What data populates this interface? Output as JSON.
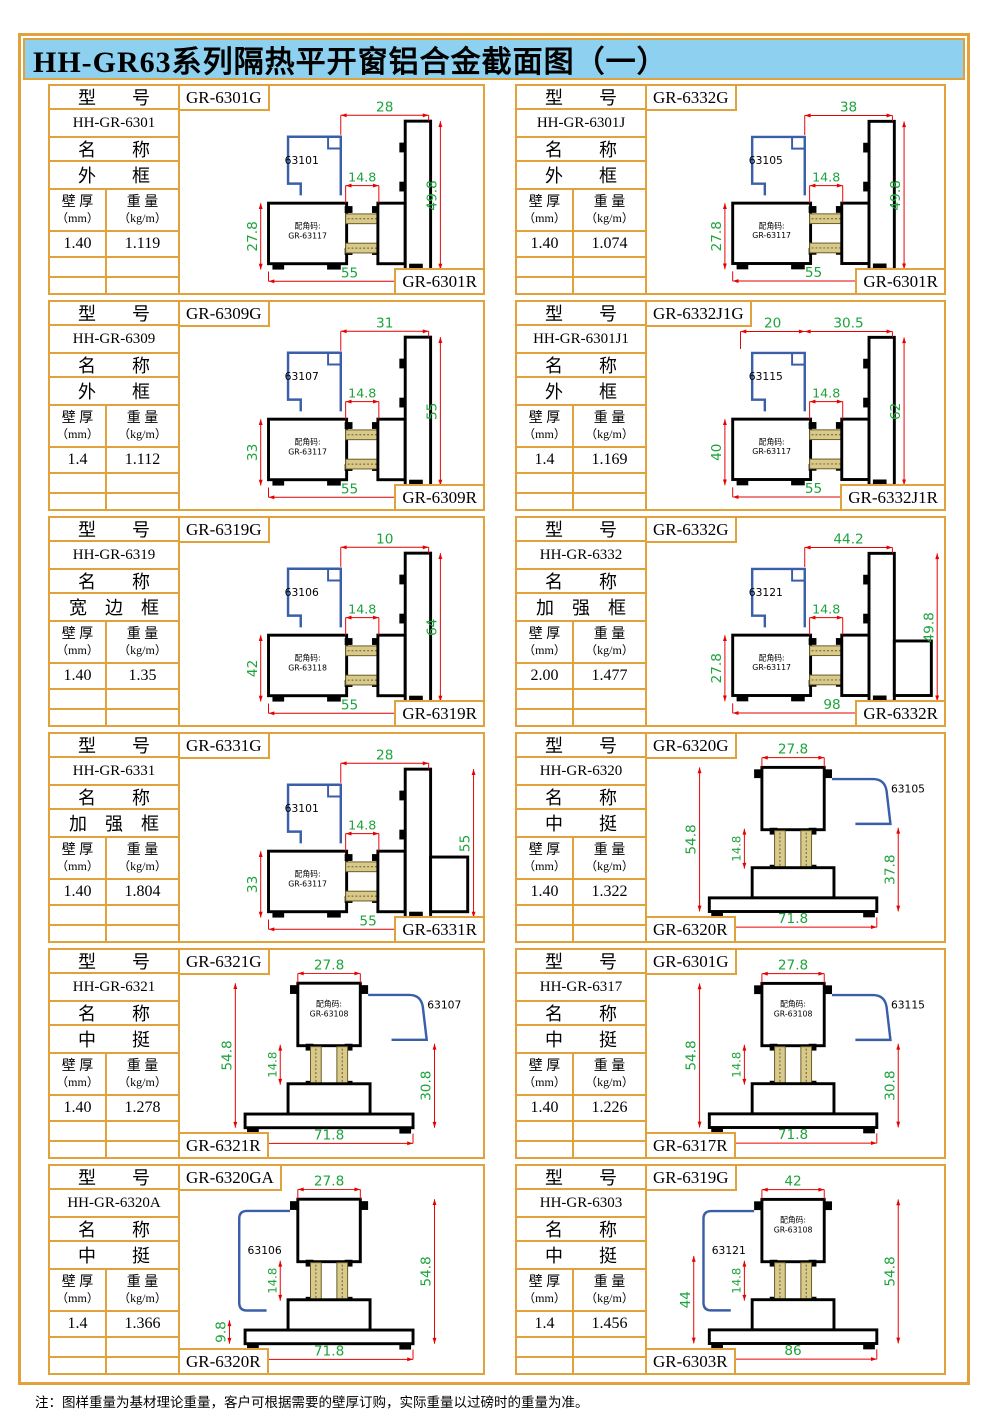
{
  "title": "HH-GR63系列隔热平开窗铝合金截面图（一）",
  "note": "注：图样重量为基材理论重量，客户可根据需要的壁厚订购，实际重量以过磅时的重量为准。",
  "labels": {
    "model": "型　　号",
    "name": "名　　称",
    "thickness": "壁 厚",
    "thickness_unit": "（mm）",
    "weight": "重 量",
    "weight_unit": "（kg/m）",
    "corner_prefix": "配角码:"
  },
  "colors": {
    "border": "#e2a23b",
    "title_bg": "#8dd0f0",
    "dim_line": "#e60000",
    "dim_text": "#1ea43c",
    "profile": "#000000",
    "sash_blue": "#3b5ea8",
    "thermal_tan": "#d8c98c"
  },
  "cells": [
    {
      "model": "HH-GR-6301",
      "type_name": "外　　框",
      "thickness": "1.40",
      "weight": "1.119",
      "glabel": "GR-6301G",
      "rlabel": "GR-6301R",
      "rside": "right",
      "part": "63101",
      "corner": "GR-63117",
      "draw": {
        "type": "A",
        "top": "28",
        "inner": "14.8",
        "left": "27.8",
        "right": "49.8",
        "bottom": "55"
      }
    },
    {
      "model": "HH-GR-6301J",
      "type_name": "外　　框",
      "thickness": "1.40",
      "weight": "1.074",
      "glabel": "GR-6332G",
      "rlabel": "GR-6301R",
      "rside": "right",
      "part": "63105",
      "corner": "GR-63117",
      "draw": {
        "type": "A",
        "top": "38",
        "inner": "14.8",
        "left": "27.8",
        "right": "49.8",
        "bottom": "55"
      }
    },
    {
      "model": "HH-GR-6309",
      "type_name": "外　　框",
      "thickness": "1.4",
      "weight": "1.112",
      "glabel": "GR-6309G",
      "rlabel": "GR-6309R",
      "rside": "right",
      "part": "63107",
      "corner": "GR-63117",
      "draw": {
        "type": "A",
        "top": "31",
        "inner": "14.8",
        "left": "33",
        "right": "55",
        "bottom": "55"
      }
    },
    {
      "model": "HH-GR-6301J1",
      "type_name": "外　　框",
      "thickness": "1.4",
      "weight": "1.169",
      "glabel": "GR-6332J1G",
      "rlabel": "GR-6332J1R",
      "rside": "right",
      "part": "63115",
      "corner": "GR-63117",
      "draw": {
        "type": "A",
        "top": "20",
        "top2": "30.5",
        "inner": "14.8",
        "left": "40",
        "right": "62",
        "bottom": "55"
      }
    },
    {
      "model": "HH-GR-6319",
      "type_name": "宽　边　框",
      "thickness": "1.40",
      "weight": "1.35",
      "glabel": "GR-6319G",
      "rlabel": "GR-6319R",
      "rside": "right",
      "part": "63106",
      "corner": "GR-63118",
      "draw": {
        "type": "A",
        "top": "10",
        "inner": "14.8",
        "left": "42",
        "right": "64",
        "bottom": "55"
      }
    },
    {
      "model": "HH-GR-6332",
      "type_name": "加　强　框",
      "thickness": "2.00",
      "weight": "1.477",
      "glabel": "GR-6332G",
      "rlabel": "GR-6332R",
      "rside": "right",
      "part": "63121",
      "corner": "GR-63117",
      "draw": {
        "type": "A",
        "ext": true,
        "top": "44.2",
        "inner": "14.8",
        "left": "27.8",
        "right": "49.8",
        "bottom": "98"
      }
    },
    {
      "model": "HH-GR-6331",
      "type_name": "加　强　框",
      "thickness": "1.40",
      "weight": "1.804",
      "glabel": "GR-6331G",
      "rlabel": "GR-6331R",
      "rside": "right",
      "part": "63101",
      "corner": "GR-63117",
      "draw": {
        "type": "A",
        "ext": true,
        "top": "28",
        "inner": "14.8",
        "left": "33",
        "right": "55",
        "bottom": "55"
      }
    },
    {
      "model": "HH-GR-6320",
      "type_name": "中　　挺",
      "thickness": "1.40",
      "weight": "1.322",
      "glabel": "GR-6320G",
      "rlabel": "GR-6320R",
      "rside": "left",
      "part": "63105",
      "corner": "",
      "blue": "right",
      "draw": {
        "type": "B",
        "top": "27.8",
        "inner": "14.8",
        "left": "54.8",
        "right": "37.8",
        "bottom": "71.8"
      }
    },
    {
      "model": "HH-GR-6321",
      "type_name": "中　　挺",
      "thickness": "1.40",
      "weight": "1.278",
      "glabel": "GR-6321G",
      "rlabel": "GR-6321R",
      "rside": "left",
      "part": "63107",
      "corner": "GR-63108",
      "blue": "right",
      "draw": {
        "type": "B",
        "top": "27.8",
        "inner": "14.8",
        "left": "54.8",
        "right": "30.8",
        "bottom": "71.8"
      }
    },
    {
      "model": "HH-GR-6317",
      "type_name": "中　　挺",
      "thickness": "1.40",
      "weight": "1.226",
      "glabel": "GR-6301G",
      "rlabel": "GR-6317R",
      "rside": "left",
      "part": "63115",
      "corner": "GR-63108",
      "blue": "right",
      "draw": {
        "type": "B",
        "top": "27.8",
        "inner": "14.8",
        "left": "54.8",
        "right": "30.8",
        "bottom": "71.8"
      }
    },
    {
      "model": "HH-GR-6320A",
      "type_name": "中　　挺",
      "thickness": "1.4",
      "weight": "1.366",
      "glabel": "GR-6320GA",
      "rlabel": "GR-6320R",
      "rside": "left",
      "part": "63106",
      "corner": "",
      "blue": "left",
      "draw": {
        "type": "B",
        "top": "27.8",
        "inner": "14.8",
        "left": "9.8",
        "left_span": "low",
        "right": "54.8",
        "bottom": "71.8"
      }
    },
    {
      "model": "HH-GR-6303",
      "type_name": "中　　挺",
      "thickness": "1.4",
      "weight": "1.456",
      "glabel": "GR-6319G",
      "rlabel": "GR-6303R",
      "rside": "left",
      "part": "63121",
      "corner": "GR-63108",
      "blue": "left",
      "draw": {
        "type": "B",
        "top": "42",
        "inner": "14.8",
        "left": "44",
        "left_span": "half",
        "right": "54.8",
        "bottom": "86"
      }
    }
  ]
}
